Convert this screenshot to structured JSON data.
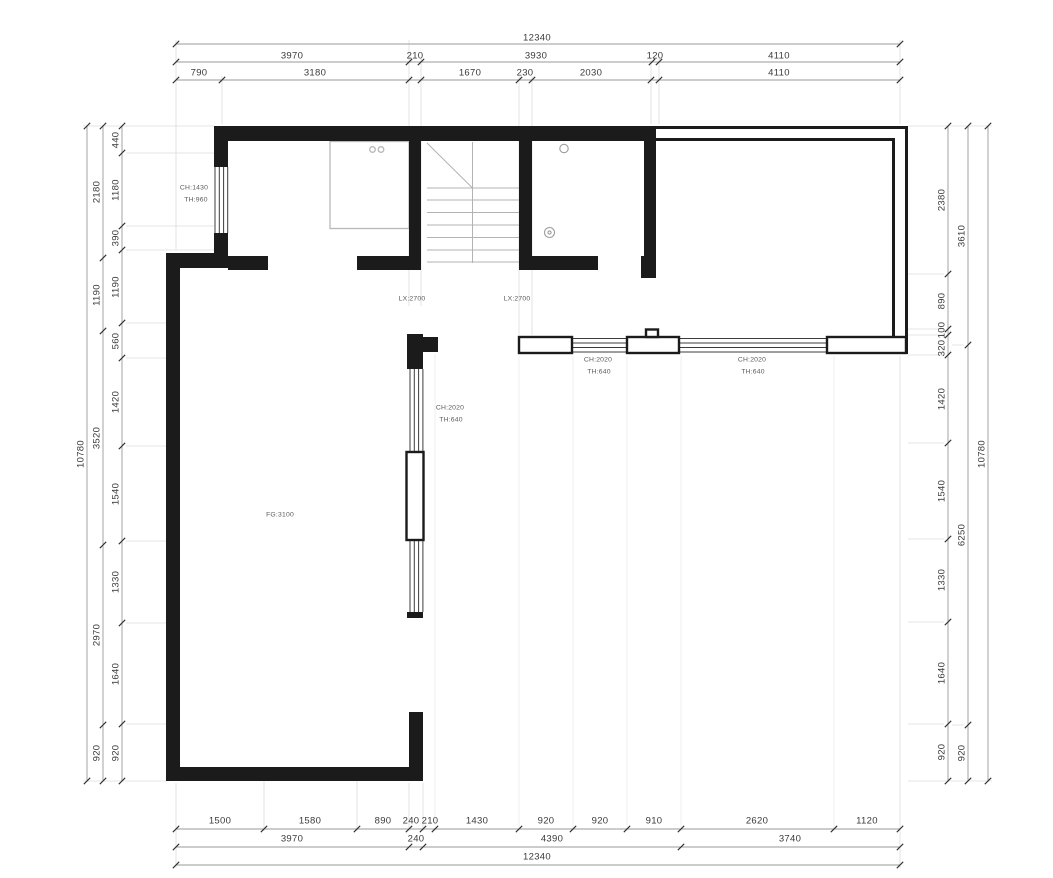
{
  "drawing": {
    "type": "architectural-floor-plan",
    "overall_width_mm": "12340",
    "overall_height_mm": "10780"
  },
  "colors": {
    "wall": "#1b1b1b",
    "dimension_line": "#9a9a9a",
    "dimension_text": "#3a3a3a",
    "tick": "#2f2f2f",
    "extension_line": "#dcdcdc",
    "fixture": "#b5b5b5",
    "stair_line": "#b3b3b3",
    "annotation_text": "#5a5a5a",
    "background": "#ffffff"
  },
  "dim_rows": [
    {
      "name": "dim-top-overall",
      "orient": "h",
      "items": [
        {
          "t": "12340",
          "x": 537,
          "y": 38
        }
      ]
    },
    {
      "name": "dim-top-major",
      "orient": "h",
      "items": [
        {
          "t": "3970",
          "x": 292,
          "y": 56
        },
        {
          "t": "210",
          "x": 415,
          "y": 56
        },
        {
          "t": "3930",
          "x": 536,
          "y": 56
        },
        {
          "t": "120",
          "x": 655,
          "y": 56
        },
        {
          "t": "4110",
          "x": 779,
          "y": 56
        }
      ]
    },
    {
      "name": "dim-top-minor",
      "orient": "h",
      "items": [
        {
          "t": "790",
          "x": 199,
          "y": 73
        },
        {
          "t": "3180",
          "x": 315,
          "y": 73
        },
        {
          "t": "1670",
          "x": 470,
          "y": 73
        },
        {
          "t": "230",
          "x": 525,
          "y": 73
        },
        {
          "t": "2030",
          "x": 591,
          "y": 73
        },
        {
          "t": "4110",
          "x": 779,
          "y": 73
        }
      ]
    },
    {
      "name": "dim-bottom-minor",
      "orient": "h",
      "items": [
        {
          "t": "1500",
          "x": 220,
          "y": 821
        },
        {
          "t": "1580",
          "x": 310,
          "y": 821
        },
        {
          "t": "890",
          "x": 383,
          "y": 821
        },
        {
          "t": "240",
          "x": 411,
          "y": 821
        },
        {
          "t": "210",
          "x": 430,
          "y": 821
        },
        {
          "t": "1430",
          "x": 477,
          "y": 821
        },
        {
          "t": "920",
          "x": 546,
          "y": 821
        },
        {
          "t": "920",
          "x": 600,
          "y": 821
        },
        {
          "t": "910",
          "x": 654,
          "y": 821
        },
        {
          "t": "2620",
          "x": 757,
          "y": 821
        },
        {
          "t": "1120",
          "x": 867,
          "y": 821
        }
      ]
    },
    {
      "name": "dim-bottom-major",
      "orient": "h",
      "items": [
        {
          "t": "3970",
          "x": 292,
          "y": 839
        },
        {
          "t": "240",
          "x": 416,
          "y": 839
        },
        {
          "t": "4390",
          "x": 552,
          "y": 839
        },
        {
          "t": "3740",
          "x": 790,
          "y": 839
        }
      ]
    },
    {
      "name": "dim-bottom-overall",
      "orient": "h",
      "items": [
        {
          "t": "12340",
          "x": 537,
          "y": 857
        }
      ]
    },
    {
      "name": "dim-left-inner",
      "orient": "v",
      "items": [
        {
          "t": "440",
          "x": 116,
          "y": 140
        },
        {
          "t": "1180",
          "x": 116,
          "y": 190
        },
        {
          "t": "390",
          "x": 116,
          "y": 238
        },
        {
          "t": "1190",
          "x": 116,
          "y": 287
        },
        {
          "t": "560",
          "x": 116,
          "y": 341
        },
        {
          "t": "1420",
          "x": 116,
          "y": 402
        },
        {
          "t": "1540",
          "x": 116,
          "y": 494
        },
        {
          "t": "1330",
          "x": 116,
          "y": 582
        },
        {
          "t": "1640",
          "x": 116,
          "y": 674
        },
        {
          "t": "920",
          "x": 116,
          "y": 753
        }
      ]
    },
    {
      "name": "dim-left-middle",
      "orient": "v",
      "items": [
        {
          "t": "2180",
          "x": 97,
          "y": 192
        },
        {
          "t": "1190",
          "x": 97,
          "y": 295
        },
        {
          "t": "3520",
          "x": 97,
          "y": 438
        },
        {
          "t": "2970",
          "x": 97,
          "y": 635
        },
        {
          "t": "920",
          "x": 97,
          "y": 753
        }
      ]
    },
    {
      "name": "dim-left-outer",
      "orient": "v",
      "items": [
        {
          "t": "10780",
          "x": 81,
          "y": 454
        }
      ]
    },
    {
      "name": "dim-right-inner",
      "orient": "v",
      "items": [
        {
          "t": "2380",
          "x": 942,
          "y": 200
        },
        {
          "t": "890",
          "x": 942,
          "y": 301
        },
        {
          "t": "100",
          "x": 942,
          "y": 330
        },
        {
          "t": "320",
          "x": 942,
          "y": 348
        },
        {
          "t": "1420",
          "x": 942,
          "y": 399
        },
        {
          "t": "1540",
          "x": 942,
          "y": 491
        },
        {
          "t": "1330",
          "x": 942,
          "y": 580
        },
        {
          "t": "1640",
          "x": 942,
          "y": 673
        },
        {
          "t": "920",
          "x": 942,
          "y": 752
        }
      ]
    },
    {
      "name": "dim-right-middle",
      "orient": "v",
      "items": [
        {
          "t": "3610",
          "x": 962,
          "y": 236
        },
        {
          "t": "6250",
          "x": 962,
          "y": 535
        },
        {
          "t": "920",
          "x": 962,
          "y": 753
        }
      ]
    },
    {
      "name": "dim-right-outer",
      "orient": "v",
      "items": [
        {
          "t": "10780",
          "x": 982,
          "y": 454
        }
      ]
    }
  ],
  "plan_labels": [
    {
      "t": "CH:1430",
      "x": 194,
      "y": 188
    },
    {
      "t": "TH:960",
      "x": 196,
      "y": 200
    },
    {
      "t": "LX:2700",
      "x": 412,
      "y": 299
    },
    {
      "t": "LX:2700",
      "x": 517,
      "y": 299
    },
    {
      "t": "CH:2020",
      "x": 450,
      "y": 408
    },
    {
      "t": "TH:640",
      "x": 451,
      "y": 420
    },
    {
      "t": "CH:2020",
      "x": 598,
      "y": 360
    },
    {
      "t": "TH:640",
      "x": 599,
      "y": 372
    },
    {
      "t": "CH:2020",
      "x": 752,
      "y": 360
    },
    {
      "t": "TH:640",
      "x": 753,
      "y": 372
    },
    {
      "t": "FG:3100",
      "x": 280,
      "y": 515
    }
  ]
}
